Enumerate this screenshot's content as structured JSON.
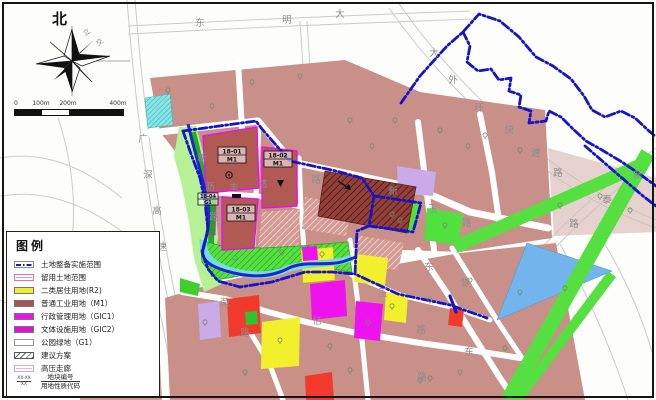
{
  "compass": {
    "north_label": "北"
  },
  "scale_bar": {
    "ticks": [
      "0",
      "100m",
      "200m",
      "400m"
    ]
  },
  "legend": {
    "title": "图例",
    "items": [
      {
        "swatch": "line",
        "label": "土地整备实施范围",
        "color": "#1818cf"
      },
      {
        "swatch": "reserve",
        "label": "留用土地范围",
        "color": "#e698cc"
      },
      {
        "swatch": "fill",
        "label": "二类居住用地(R2)",
        "color": "#f2ef2c"
      },
      {
        "swatch": "fill",
        "label": "普通工业用地（M1）",
        "color": "#a4544e"
      },
      {
        "swatch": "fill",
        "label": "行政管理用地（GIC1）",
        "color": "#ee10ee"
      },
      {
        "swatch": "fill",
        "label": "文体设施用地（GIC2）",
        "color": "#e010d6"
      },
      {
        "swatch": "outline",
        "label": "公园绿地（G1）",
        "color": "#ffffff"
      },
      {
        "swatch": "hatch",
        "label": "建议方案",
        "color": "#666666"
      },
      {
        "swatch": "hv",
        "label": "高压走廊",
        "color": "#f0b6d2"
      },
      {
        "swatch": "code",
        "label_top": "地块编号",
        "label_bottom": "用地性质代码",
        "sample_top": "XX-XX",
        "sample_bottom": "XX"
      }
    ]
  },
  "plots": [
    {
      "id": "18-01",
      "code": "M1",
      "x": 218,
      "y": 147,
      "w": 28,
      "h": 16
    },
    {
      "id": "18-02",
      "code": "M1",
      "x": 264,
      "y": 151,
      "w": 28,
      "h": 16
    },
    {
      "id": "18-03",
      "code": "M1",
      "x": 227,
      "y": 205,
      "w": 28,
      "h": 16
    },
    {
      "id": "18-04",
      "code": "G1",
      "x": 198,
      "y": 193,
      "w": 20,
      "h": 12
    }
  ],
  "roads": [
    {
      "name": "东明大道",
      "chars": [
        {
          "t": "东",
          "x": 200,
          "y": 26
        },
        {
          "t": "明",
          "x": 287,
          "y": 23
        },
        {
          "t": "大",
          "x": 340,
          "y": 17
        }
      ]
    },
    {
      "name": "大外环快速路",
      "chars": [
        {
          "t": "大",
          "x": 434,
          "y": 56
        },
        {
          "t": "外",
          "x": 453,
          "y": 83
        },
        {
          "t": "环",
          "x": 479,
          "y": 111
        },
        {
          "t": "快",
          "x": 509,
          "y": 133
        },
        {
          "t": "速",
          "x": 536,
          "y": 156
        },
        {
          "t": "路",
          "x": 558,
          "y": 176
        }
      ]
    },
    {
      "name": "新泰路",
      "chars": [
        {
          "t": "新",
          "x": 638,
          "y": 178
        },
        {
          "t": "泰",
          "x": 607,
          "y": 203
        },
        {
          "t": "路",
          "x": 574,
          "y": 227
        }
      ]
    },
    {
      "name": "广深高速",
      "chars": [
        {
          "t": "广",
          "x": 143,
          "y": 142
        },
        {
          "t": "深",
          "x": 148,
          "y": 178
        },
        {
          "t": "高",
          "x": 157,
          "y": 214
        },
        {
          "t": "速",
          "x": 162,
          "y": 250
        }
      ]
    },
    {
      "name": "立交",
      "chars": [
        {
          "t": "立",
          "x": 88,
          "y": 34,
          "r": -35,
          "s": 7
        },
        {
          "t": "交",
          "x": 101,
          "y": 44,
          "r": -35,
          "s": 7
        }
      ]
    },
    {
      "name": "新沥路",
      "chars": [
        {
          "t": "新",
          "x": 202,
          "y": 161
        },
        {
          "t": "沥",
          "x": 210,
          "y": 190
        },
        {
          "t": "路",
          "x": 214,
          "y": 220
        }
      ]
    },
    {
      "name": "丰达路",
      "chars": [
        {
          "t": "丰",
          "x": 234,
          "y": 191
        },
        {
          "t": "达",
          "x": 263,
          "y": 187
        },
        {
          "t": "路",
          "x": 316,
          "y": 183
        }
      ]
    },
    {
      "name": "新玉路",
      "chars": [
        {
          "t": "新",
          "x": 393,
          "y": 194
        },
        {
          "t": "玉",
          "x": 433,
          "y": 212
        },
        {
          "t": "路",
          "x": 467,
          "y": 226
        }
      ]
    },
    {
      "name": "玉路",
      "chars": [
        {
          "t": "玉",
          "x": 383,
          "y": 296
        },
        {
          "t": "路",
          "x": 421,
          "y": 333
        }
      ]
    },
    {
      "name": "东甘",
      "chars": [
        {
          "t": "东",
          "x": 429,
          "y": 270
        },
        {
          "t": "甘",
          "x": 465,
          "y": 286
        }
      ]
    },
    {
      "name": "东路",
      "chars": [
        {
          "t": "东",
          "x": 469,
          "y": 355
        },
        {
          "t": "路",
          "x": 422,
          "y": 380
        }
      ]
    },
    {
      "name": "荣路",
      "chars": [
        {
          "t": "荣",
          "x": 225,
          "y": 306
        },
        {
          "t": "路",
          "x": 245,
          "y": 336
        }
      ]
    },
    {
      "name": "亿",
      "chars": [
        {
          "t": "亿",
          "x": 317,
          "y": 324
        }
      ]
    }
  ]
}
